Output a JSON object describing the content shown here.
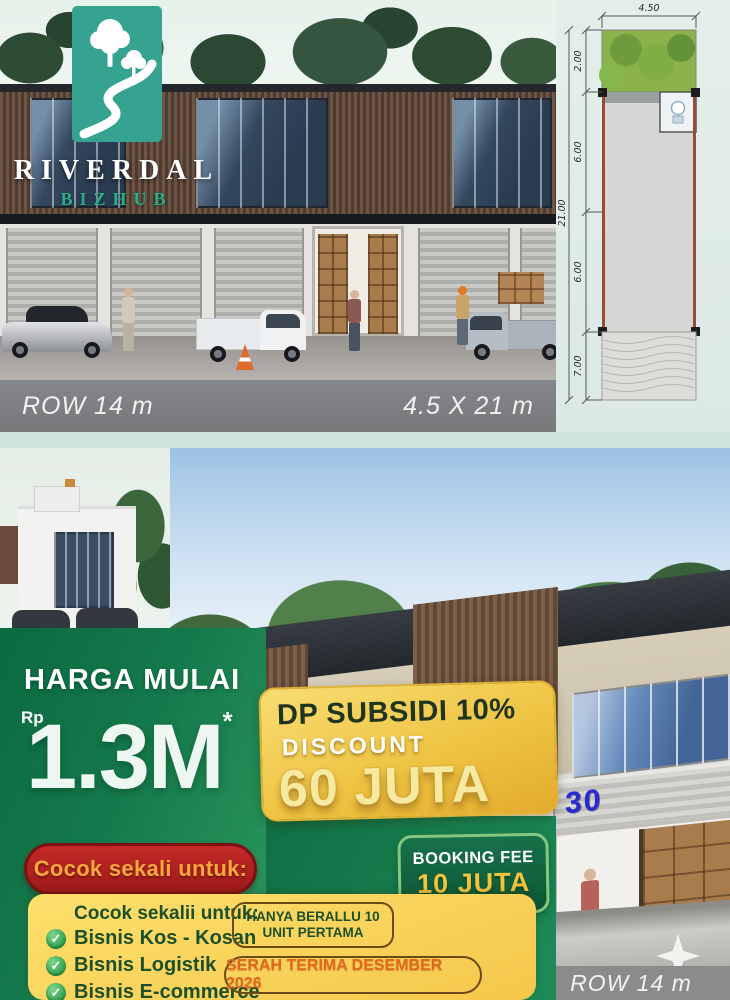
{
  "colors": {
    "page_bg": "#cfe4da",
    "brand_teal": "#35a390",
    "promo_green_dark": "#0a6a40",
    "promo_green_light": "#2c9a5f",
    "gold_card": "#efc443",
    "yellow_card": "#f9d45c",
    "ribbon_red": "#b32220",
    "booking_green": "#0d5636",
    "text_dark_green": "#1d4f2a",
    "handover_orange": "#e2661c",
    "unit_number_blue": "#2a2acc"
  },
  "icons": {
    "check_glyph": "✓"
  },
  "header_render": {
    "brand": "RIVERDAL",
    "brand_sub": "BIZHUB",
    "row_label": "ROW 14 m",
    "size_label": "4.5 X 21 m"
  },
  "floorplan": {
    "width": "4.50",
    "garden_depth": "2.00",
    "mid_depth_a": "6.00",
    "mid_depth_b": "6.00",
    "front_depth": "7.00",
    "total_depth": "21.00"
  },
  "promo": {
    "price_heading": "HARGA MULAI",
    "currency": "Rp",
    "price": "1.3M",
    "price_note": "*",
    "dp_title": "DP SUBSIDI 10%",
    "discount_label": "DISCOUNT",
    "discount_value": "60 JUTA",
    "booking_label": "BOOKING FEE",
    "booking_value": "10 JUTA"
  },
  "suitable": {
    "ribbon": "Cocok sekali untuk:",
    "heading": "Cocok sekalii untuk:",
    "items": [
      "Bisnis Kos - Kosan",
      "Bisnis Logistik",
      "Bisnis E-commerce"
    ],
    "limited_line1": "HANYA BERALLU 10",
    "limited_line2": "UNIT PERTAMA",
    "handover": "SERAH TERIMA DESEMBER 2026"
  },
  "footer_render": {
    "unit_number": "30",
    "row_label": "ROW 14 m"
  }
}
